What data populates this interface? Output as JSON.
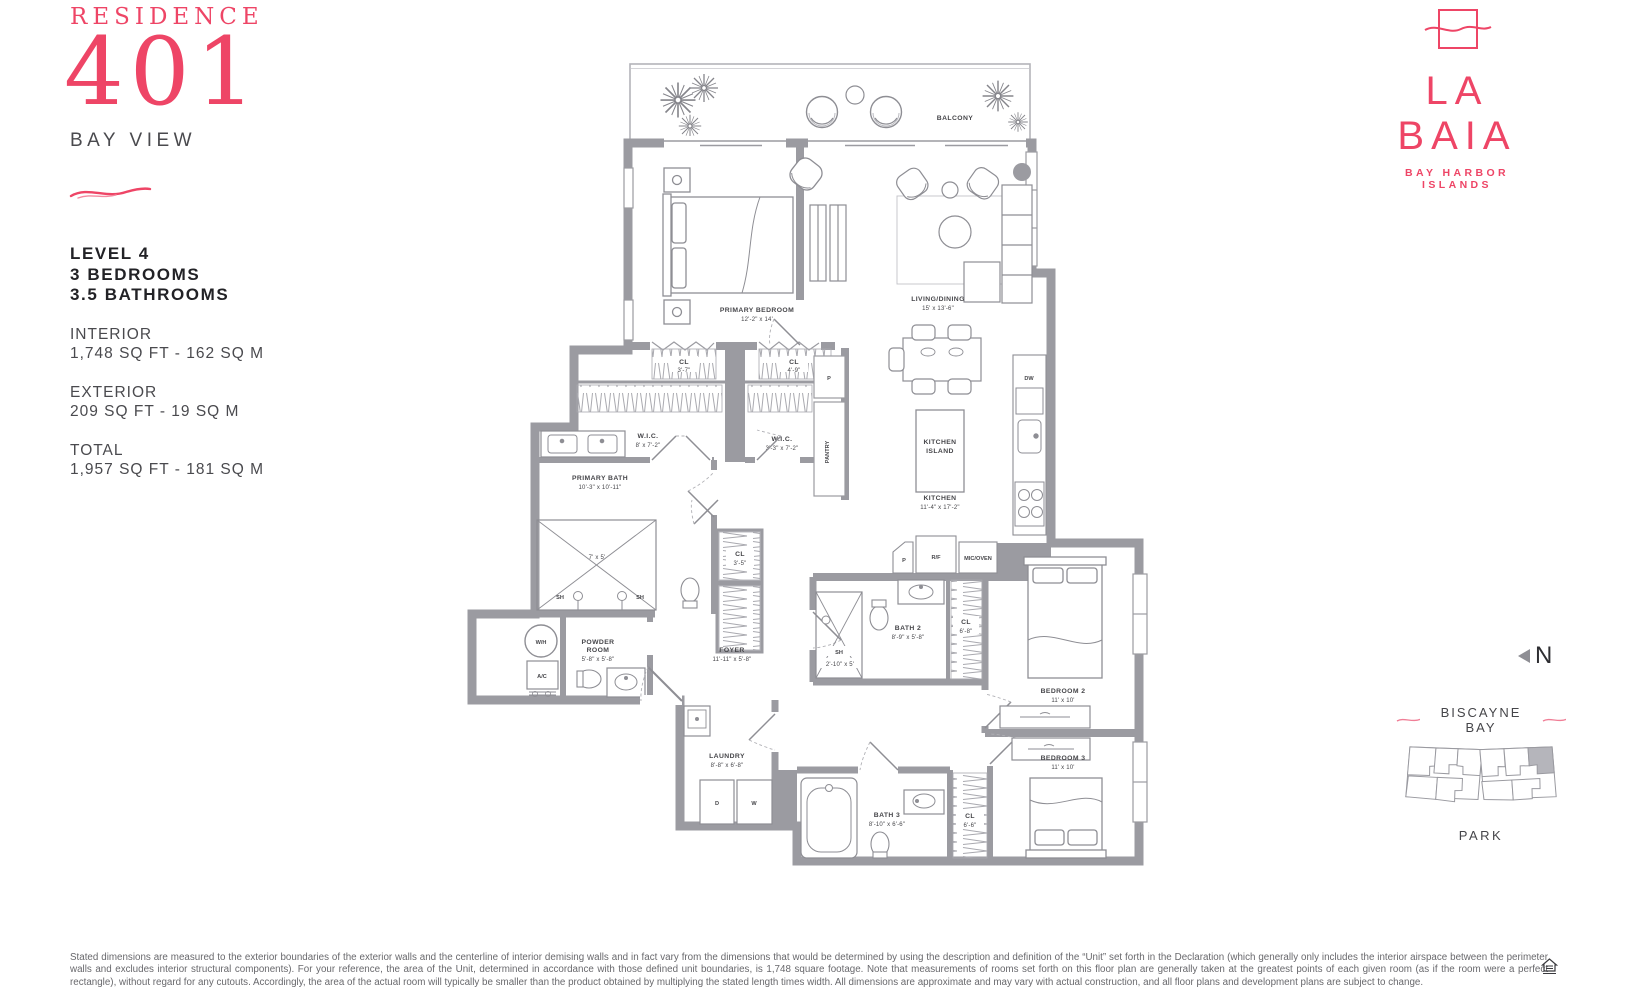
{
  "header": {
    "residence_label": "RESIDENCE",
    "residence_number": "401",
    "view_label": "BAY VIEW",
    "level": "LEVEL 4",
    "bedrooms": "3 BEDROOMS",
    "bathrooms": "3.5 BATHROOMS",
    "interior_label": "INTERIOR",
    "interior_value": "1,748 SQ FT - 162 SQ M",
    "exterior_label": "EXTERIOR",
    "exterior_value": "209 SQ FT - 19 SQ M",
    "total_label": "TOTAL",
    "total_value": "1,957 SQ FT - 181 SQ M"
  },
  "brand": {
    "name": "LA BAIA",
    "tagline": "BAY HARBOR ISLANDS",
    "accent_color": "#ee4566"
  },
  "sideinfo": {
    "compass": "N",
    "water_label": "BISCAYNE BAY",
    "park_label": "PARK"
  },
  "floorplan": {
    "labels": {
      "balcony": "BALCONY",
      "primary_bedroom": {
        "name": "PRIMARY BEDROOM",
        "dim": "12'-2\" x 14'"
      },
      "living": {
        "name": "LIVING/DINING",
        "dim": "15' x 13'-6\""
      },
      "cl1": {
        "name": "CL",
        "dim": "3'-7\""
      },
      "cl2": {
        "name": "CL",
        "dim": "4'-9\""
      },
      "wic1": {
        "name": "W.I.C.",
        "dim": "8' x 7'-2\""
      },
      "wic2": {
        "name": "W.I.C.",
        "dim": "3'-3\" x 7'-2\""
      },
      "pantry_p": "P",
      "pantry": "PANTRY",
      "kitchen": {
        "name": "KITCHEN",
        "dim": "11'-4\" x 17'-2\""
      },
      "island_l1": "KITCHEN",
      "island_l2": "ISLAND",
      "dw": "DW",
      "primary_bath": {
        "name": "PRIMARY BATH",
        "dim": "10'-3\" x 10'-11\""
      },
      "shower_dim": "7' x 5'",
      "sh": "SH",
      "sh_dim": "2'-10\" x 5'",
      "cl_hall": {
        "name": "CL",
        "dim": "3'-5\""
      },
      "powder_l1": "POWDER",
      "powder_l2": "ROOM",
      "powder_dim": "5'-8\" x 5'-8\"",
      "foyer": {
        "name": "FOYER",
        "dim": "11'-11\" x 5'-8\""
      },
      "wh": "W/H",
      "ac": "A/C",
      "p2": "P",
      "rf": "R/F",
      "mic": "MIC/OVEN",
      "bath2": {
        "name": "BATH 2",
        "dim": "8'-9\" x 5'-8\""
      },
      "cl_b2": {
        "name": "CL",
        "dim": "6'-8\""
      },
      "bed2": {
        "name": "BEDROOM 2",
        "dim": "11' x 10'"
      },
      "laundry": {
        "name": "LAUNDRY",
        "dim": "8'-8\" x 6'-8\""
      },
      "d": "D",
      "w": "W",
      "bath3": {
        "name": "BATH 3",
        "dim": "8'-10\" x 6'-6\""
      },
      "cl_b3": {
        "name": "CL",
        "dim": "6'-6\""
      },
      "bed3": {
        "name": "BEDROOM 3",
        "dim": "11' x 10'"
      }
    }
  },
  "disclaimer": "Stated dimensions are measured to the exterior boundaries of the exterior walls and the centerline of interior demising walls and in fact vary from the dimensions that would be determined by using the description and definition of the “Unit” set forth in the Declaration (which generally only includes the interior airspace between the perimeter walls and excludes interior structural components).  For your reference, the area of the Unit, determined in accordance with those defined unit boundaries, is 1,748 square footage. Note that measurements of rooms set forth on this floor plan are generally taken at the greatest points of each given room (as if the room were a perfect rectangle), without regard for any cutouts. Accordingly, the area of the actual room will typically be smaller than the product obtained by multiplying the stated length times width. All dimensions are approximate and may vary with actual construction, and all floor plans and development plans are subject to change."
}
